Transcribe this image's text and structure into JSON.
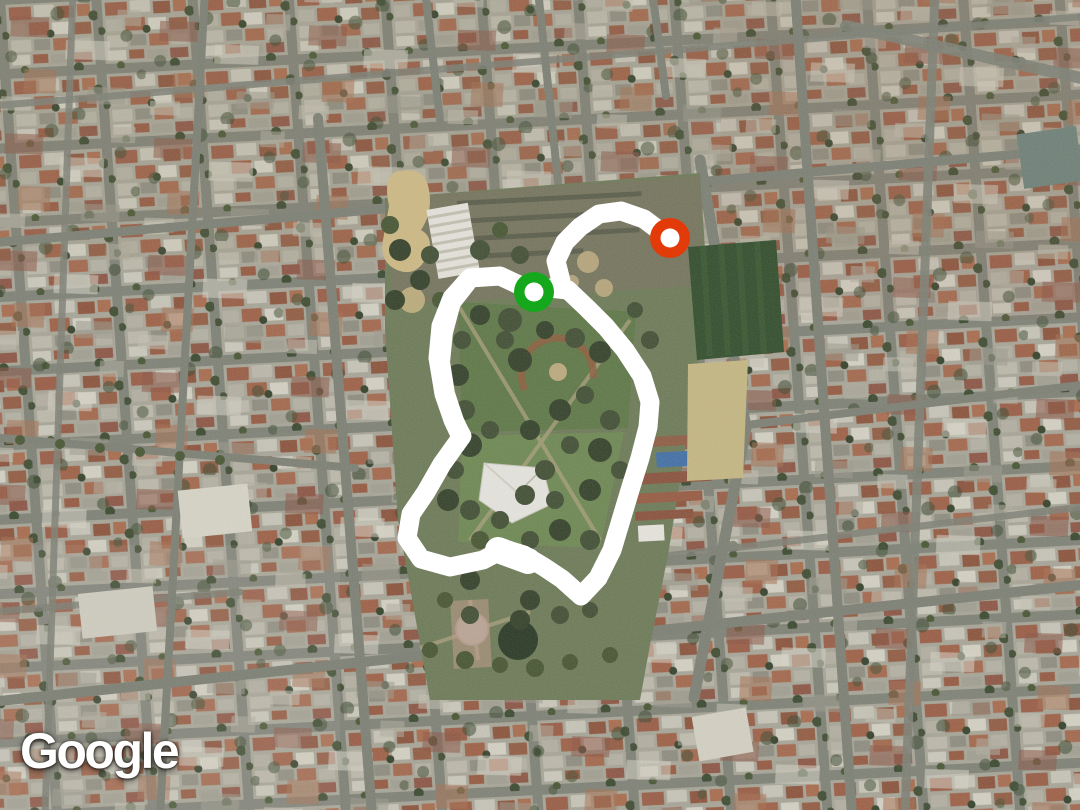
{
  "watermark": {
    "label": "Google"
  },
  "map": {
    "imagery_type": "satellite",
    "route": {
      "color": "#ffffff",
      "stroke_width": 19,
      "loop": [
        [
          534,
          292
        ],
        [
          500,
          276
        ],
        [
          470,
          278
        ],
        [
          452,
          298
        ],
        [
          441,
          326
        ],
        [
          438,
          358
        ],
        [
          444,
          394
        ],
        [
          453,
          420
        ],
        [
          462,
          436
        ],
        [
          442,
          464
        ],
        [
          426,
          492
        ],
        [
          411,
          514
        ],
        [
          407,
          538
        ],
        [
          421,
          559
        ],
        [
          450,
          567
        ],
        [
          483,
          560
        ],
        [
          504,
          549
        ],
        [
          524,
          555
        ],
        [
          544,
          567
        ],
        [
          562,
          579
        ],
        [
          581,
          596
        ],
        [
          598,
          578
        ],
        [
          612,
          550
        ],
        [
          621,
          520
        ],
        [
          630,
          490
        ],
        [
          640,
          458
        ],
        [
          648,
          427
        ],
        [
          650,
          402
        ],
        [
          642,
          376
        ],
        [
          625,
          350
        ],
        [
          606,
          327
        ],
        [
          587,
          308
        ],
        [
          568,
          290
        ],
        [
          549,
          288
        ]
      ],
      "tail": [
        [
          561,
          281
        ],
        [
          556,
          261
        ],
        [
          565,
          242
        ],
        [
          580,
          227
        ],
        [
          599,
          214
        ],
        [
          621,
          211
        ],
        [
          644,
          219
        ],
        [
          668,
          237
        ]
      ],
      "extra_strokes": [
        {
          "points": [
            [
              466,
              283
            ],
            [
              451,
              302
            ],
            [
              443,
              332
            ],
            [
              440,
              362
            ],
            [
              445,
              394
            ],
            [
              454,
              421
            ],
            [
              461,
              436
            ]
          ],
          "width": 20
        },
        {
          "points": [
            [
              498,
              550
            ],
            [
              528,
              561
            ]
          ],
          "width": 26
        }
      ]
    },
    "markers": [
      {
        "id": "start",
        "label": "route-start",
        "color": "#15a81c",
        "inner_color": "#ffffff",
        "x": 534,
        "y": 292,
        "r_outer": 20,
        "r_inner": 9.5
      },
      {
        "id": "end",
        "label": "route-end",
        "color": "#e23a09",
        "inner_color": "#ffffff",
        "x": 670,
        "y": 238,
        "r_outer": 20,
        "r_inner": 9.5
      }
    ],
    "palette": {
      "street": "#7e8176",
      "block": "#a9a799",
      "park_base": "#6b7a55",
      "lawn_upper": "#5c7744",
      "lawn_lower": "#6d8950",
      "tree_dark": "#2f3d25",
      "pitch_green": "#2c4a27",
      "bare_field_tan": "#c9ba83",
      "roof_red": "#9a5a42"
    }
  }
}
